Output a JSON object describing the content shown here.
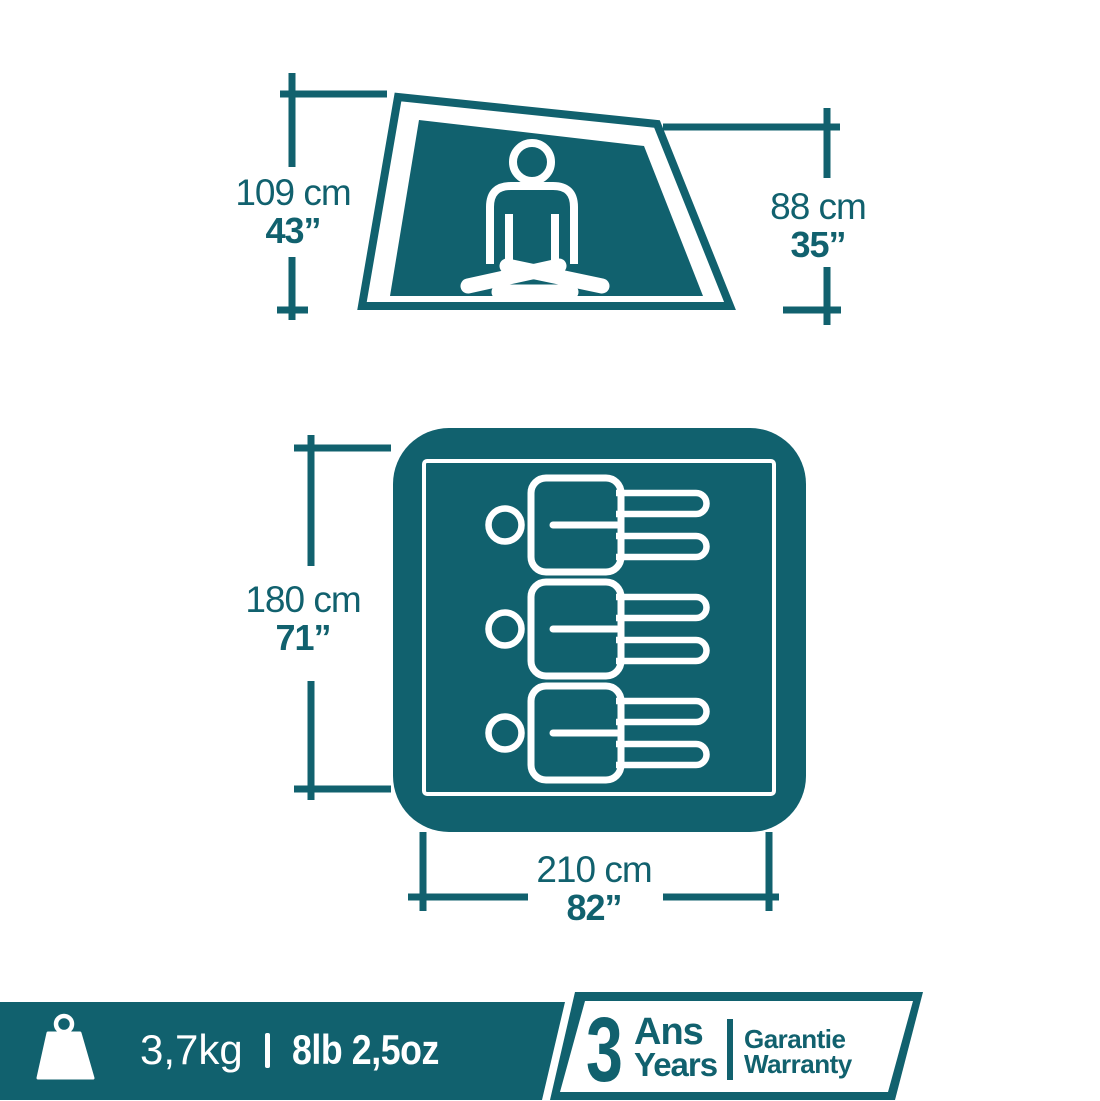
{
  "colors": {
    "teal": "#11616e",
    "white": "#ffffff"
  },
  "side_view": {
    "left_dim": {
      "cm": "109 cm",
      "inches": "43”"
    },
    "right_dim": {
      "cm": "88 cm",
      "inches": "35”"
    }
  },
  "floor_plan": {
    "length_dim": {
      "cm": "180 cm",
      "inches": "71”"
    },
    "width_dim": {
      "cm": "210 cm",
      "inches": "82”"
    },
    "sleeper_count": "3"
  },
  "footer": {
    "weight_metric": "3,7kg",
    "weight_imperial": "8lb 2,5oz",
    "warranty": {
      "years": "3",
      "unit_fr": "Ans",
      "unit_en": "Years",
      "label_fr": "Garantie",
      "label_en": "Warranty"
    }
  }
}
